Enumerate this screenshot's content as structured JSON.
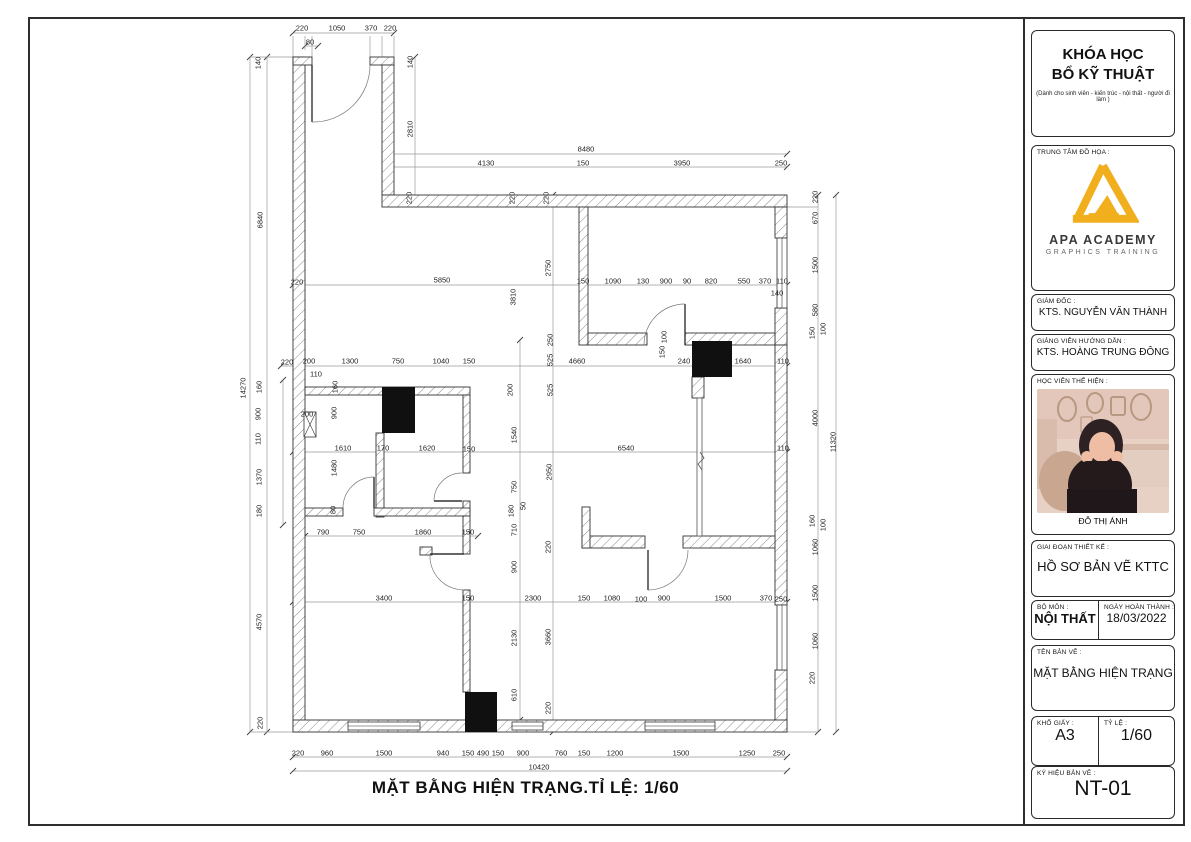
{
  "page": {
    "caption": "MẶT BẰNG HIỆN TRẠNG.TỈ LỆ: 1/60"
  },
  "title_block": {
    "course_title_line1": "KHÓA HỌC",
    "course_title_line2": "BỔ KỸ THUẬT",
    "course_subtitle": "(Dành cho sinh viên - kiến trúc - nội thất - người đi làm )",
    "center_label": "TRUNG TÂM ĐỒ HỌA :",
    "logo_name": "APA ACADEMY",
    "logo_tagline": "GRAPHICS TRAINING",
    "accent_color": "#F1AE1D",
    "director_label": "GIÁM ĐỐC :",
    "director_name": "KTS. NGUYỄN VĂN THÀNH",
    "lecturer_label": "GIẢNG VIÊN HƯỚNG DẪN :",
    "lecturer_name": "KTS. HOÀNG TRUNG ĐÔNG",
    "student_label": "HỌC VIÊN THỂ HIỆN :",
    "student_name": "ĐỖ THỊ ÁNH",
    "phase_label": "GIAI ĐOẠN THIẾT KẾ :",
    "phase_value": "HỒ SƠ BẢN VẼ KTTC",
    "subject_label": "BỘ MÔN :",
    "subject_value": "NỘI THẤT",
    "date_label": "NGÀY HOÀN THÀNH :",
    "date_value": "18/03/2022",
    "drawing_name_label": "TÊN BẢN VẼ :",
    "drawing_name_value": "MẶT BẰNG HIỆN TRẠNG",
    "paper_label": "KHỔ GIẤY :",
    "paper_value": "A3",
    "scale_label": "TỶ LỆ :",
    "scale_value": "1/60",
    "code_label": "KÝ HIỆU BẢN VẼ :",
    "code_value": "NT-01"
  },
  "plan": {
    "line_color": "#333333",
    "dim_color": "#555555",
    "walls": [
      [
        293,
        57,
        12,
        675
      ],
      [
        293,
        57,
        19,
        8
      ],
      [
        370,
        57,
        24,
        8
      ],
      [
        382,
        65,
        12,
        130
      ],
      [
        382,
        195,
        405,
        12
      ],
      [
        775,
        207,
        12,
        31
      ],
      [
        775,
        308,
        12,
        37
      ],
      [
        775,
        345,
        12,
        260
      ],
      [
        775,
        670,
        12,
        62
      ],
      [
        293,
        720,
        494,
        12
      ],
      [
        579,
        207,
        9,
        138
      ],
      [
        588,
        333,
        59,
        12
      ],
      [
        685,
        333,
        90,
        12
      ],
      [
        305,
        387,
        165,
        8
      ],
      [
        376,
        433,
        8,
        84
      ],
      [
        463,
        395,
        7,
        78
      ],
      [
        463,
        501,
        7,
        15
      ],
      [
        305,
        508,
        38,
        8
      ],
      [
        374,
        508,
        96,
        8
      ],
      [
        463,
        516,
        7,
        38
      ],
      [
        463,
        590,
        7,
        102
      ],
      [
        692,
        377,
        12,
        21
      ],
      [
        582,
        536,
        63,
        12
      ],
      [
        683,
        536,
        92,
        12
      ],
      [
        582,
        507,
        8,
        41
      ],
      [
        420,
        547,
        12,
        8
      ]
    ],
    "shafts": [
      [
        692,
        341,
        40,
        36
      ],
      [
        382,
        387,
        33,
        46
      ],
      [
        465,
        692,
        32,
        40
      ]
    ],
    "windows": [
      {
        "r": [
          777,
          238,
          10,
          70
        ],
        "o": "v"
      },
      {
        "r": [
          777,
          605,
          10,
          65
        ],
        "o": "v"
      },
      {
        "r": [
          348,
          722,
          72,
          8
        ],
        "o": "h"
      },
      {
        "r": [
          512,
          722,
          31,
          8
        ],
        "o": "h"
      },
      {
        "r": [
          645,
          722,
          70,
          8
        ],
        "o": "h"
      }
    ],
    "duct": [
      304,
      412,
      12,
      25
    ],
    "partition": {
      "r": [
        697,
        398,
        5,
        138
      ],
      "break": [
        700,
        452,
        704,
        458,
        698,
        464,
        702,
        470
      ]
    },
    "doors": [
      {
        "h": [
          312,
          65
        ],
        "l": [
          312,
          122
        ],
        "a": [
          370,
          65
        ],
        "s": 0
      },
      {
        "h": [
          685,
          345
        ],
        "l": [
          685,
          304
        ],
        "a": [
          644,
          345
        ],
        "s": 0
      },
      {
        "h": [
          374,
          508
        ],
        "l": [
          374,
          477
        ],
        "a": [
          343,
          508
        ],
        "s": 0
      },
      {
        "h": [
          462,
          501
        ],
        "l": [
          434,
          501
        ],
        "a": [
          462,
          473
        ],
        "s": 1
      },
      {
        "h": [
          648,
          550
        ],
        "l": [
          648,
          590
        ],
        "a": [
          688,
          550
        ],
        "s": 0
      },
      {
        "h": [
          464,
          554
        ],
        "l": [
          430,
          554
        ],
        "a": [
          464,
          590
        ],
        "s": 0
      }
    ],
    "dim_lines": [
      [
        293,
        33,
        394,
        33,
        1
      ],
      [
        305,
        46,
        318,
        46,
        1
      ],
      [
        385,
        154,
        787,
        154,
        1
      ],
      [
        385,
        167,
        787,
        167,
        1
      ],
      [
        293,
        285,
        787,
        285,
        1
      ],
      [
        281,
        366,
        787,
        366,
        1
      ],
      [
        293,
        452,
        787,
        452,
        1
      ],
      [
        305,
        536,
        478,
        536,
        1
      ],
      [
        293,
        602,
        787,
        602,
        1
      ],
      [
        293,
        757,
        787,
        757,
        1
      ],
      [
        293,
        771,
        787,
        771,
        1
      ],
      [
        250,
        57,
        250,
        732,
        1
      ],
      [
        267,
        57,
        267,
        732,
        1
      ],
      [
        283,
        380,
        283,
        525,
        1
      ],
      [
        415,
        57,
        415,
        200,
        1
      ],
      [
        553,
        195,
        553,
        732,
        1
      ],
      [
        520,
        340,
        520,
        720,
        1
      ],
      [
        818,
        195,
        818,
        732,
        1
      ],
      [
        836,
        195,
        836,
        732,
        1
      ],
      [
        293,
        36,
        293,
        57,
        0
      ],
      [
        305,
        36,
        305,
        50,
        0
      ],
      [
        312,
        36,
        312,
        57,
        0
      ],
      [
        370,
        36,
        370,
        57,
        0
      ],
      [
        382,
        36,
        382,
        57,
        0
      ],
      [
        394,
        36,
        394,
        57,
        0
      ],
      [
        250,
        57,
        293,
        57,
        0
      ],
      [
        250,
        732,
        293,
        732,
        0
      ],
      [
        818,
        207,
        787,
        207,
        0
      ],
      [
        818,
        732,
        787,
        732,
        0
      ]
    ],
    "dim_labels": [
      [
        302,
        28,
        "220",
        0
      ],
      [
        337,
        28,
        "1050",
        0
      ],
      [
        371,
        28,
        "370",
        0
      ],
      [
        390,
        28,
        "220",
        0
      ],
      [
        310,
        42,
        "80",
        0
      ],
      [
        258,
        63,
        "140",
        1
      ],
      [
        410,
        62,
        "140",
        1
      ],
      [
        410,
        129,
        "2810",
        1
      ],
      [
        586,
        149,
        "8480",
        0
      ],
      [
        486,
        163,
        "4130",
        0
      ],
      [
        583,
        163,
        "150",
        0
      ],
      [
        682,
        163,
        "3950",
        0
      ],
      [
        781,
        163,
        "250",
        0
      ],
      [
        409,
        198,
        "220",
        1
      ],
      [
        512,
        198,
        "220",
        1
      ],
      [
        546,
        198,
        "220",
        1
      ],
      [
        815,
        197,
        "220",
        1
      ],
      [
        815,
        218,
        "670",
        1
      ],
      [
        815,
        265,
        "1500",
        1
      ],
      [
        815,
        310,
        "580",
        1
      ],
      [
        812,
        333,
        "150",
        1
      ],
      [
        823,
        329,
        "100",
        1
      ],
      [
        815,
        418,
        "4000",
        1
      ],
      [
        833,
        442,
        "11320",
        1
      ],
      [
        812,
        521,
        "160",
        1
      ],
      [
        823,
        525,
        "100",
        1
      ],
      [
        815,
        547,
        "1060",
        1
      ],
      [
        815,
        593,
        "1500",
        1
      ],
      [
        815,
        641,
        "1060",
        1
      ],
      [
        812,
        678,
        "220",
        1
      ],
      [
        442,
        280,
        "5850",
        0
      ],
      [
        583,
        281,
        "150",
        0
      ],
      [
        613,
        281,
        "1090",
        0
      ],
      [
        643,
        281,
        "130",
        0
      ],
      [
        666,
        281,
        "900",
        0
      ],
      [
        687,
        281,
        "90",
        0
      ],
      [
        711,
        281,
        "820",
        0
      ],
      [
        744,
        281,
        "550",
        0
      ],
      [
        765,
        281,
        "370",
        0
      ],
      [
        782,
        281,
        "110",
        0
      ],
      [
        777,
        293,
        "140",
        0
      ],
      [
        548,
        268,
        "2750",
        1
      ],
      [
        513,
        297,
        "3810",
        1
      ],
      [
        297,
        282,
        "220",
        0
      ],
      [
        287,
        362,
        "220",
        0
      ],
      [
        309,
        361,
        "200",
        0
      ],
      [
        350,
        361,
        "1300",
        0
      ],
      [
        398,
        361,
        "750",
        0
      ],
      [
        441,
        361,
        "1040",
        0
      ],
      [
        469,
        361,
        "150",
        0
      ],
      [
        316,
        374,
        "110",
        0
      ],
      [
        577,
        361,
        "4660",
        0
      ],
      [
        684,
        361,
        "240",
        0
      ],
      [
        743,
        361,
        "1640",
        0
      ],
      [
        783,
        361,
        "110",
        0
      ],
      [
        664,
        337,
        "100",
        1
      ],
      [
        662,
        352,
        "150",
        1
      ],
      [
        550,
        340,
        "250",
        1
      ],
      [
        550,
        360,
        "525",
        1
      ],
      [
        550,
        390,
        "525",
        1
      ],
      [
        549,
        472,
        "2950",
        1
      ],
      [
        548,
        547,
        "220",
        1
      ],
      [
        548,
        637,
        "3660",
        1
      ],
      [
        548,
        708,
        "220",
        1
      ],
      [
        510,
        390,
        "200",
        1
      ],
      [
        514,
        435,
        "1540",
        1
      ],
      [
        514,
        487,
        "750",
        1
      ],
      [
        523,
        506,
        "50",
        1
      ],
      [
        511,
        511,
        "180",
        1
      ],
      [
        514,
        530,
        "710",
        1
      ],
      [
        514,
        567,
        "900",
        1
      ],
      [
        514,
        638,
        "2130",
        1
      ],
      [
        514,
        695,
        "610",
        1
      ],
      [
        243,
        388,
        "14270",
        1
      ],
      [
        260,
        220,
        "6840",
        1
      ],
      [
        259,
        387,
        "160",
        1
      ],
      [
        258,
        414,
        "900",
        1
      ],
      [
        258,
        439,
        "110",
        1
      ],
      [
        259,
        477,
        "1370",
        1
      ],
      [
        259,
        511,
        "180",
        1
      ],
      [
        259,
        622,
        "4570",
        1
      ],
      [
        260,
        723,
        "220",
        1
      ],
      [
        307,
        414,
        "200",
        0
      ],
      [
        334,
        413,
        "900",
        1
      ],
      [
        334,
        468,
        "1480",
        1
      ],
      [
        335,
        387,
        "160",
        1
      ],
      [
        333,
        510,
        "80",
        1
      ],
      [
        343,
        448,
        "1610",
        0
      ],
      [
        383,
        448,
        "170",
        0
      ],
      [
        427,
        448,
        "1620",
        0
      ],
      [
        469,
        449,
        "150",
        0
      ],
      [
        626,
        448,
        "6540",
        0
      ],
      [
        783,
        448,
        "110",
        0
      ],
      [
        323,
        532,
        "790",
        0
      ],
      [
        359,
        532,
        "750",
        0
      ],
      [
        423,
        532,
        "1860",
        0
      ],
      [
        468,
        532,
        "150",
        0
      ],
      [
        384,
        598,
        "3400",
        0
      ],
      [
        468,
        598,
        "150",
        0
      ],
      [
        533,
        598,
        "2300",
        0
      ],
      [
        584,
        598,
        "150",
        0
      ],
      [
        612,
        598,
        "1080",
        0
      ],
      [
        641,
        599,
        "100",
        0
      ],
      [
        664,
        598,
        "900",
        0
      ],
      [
        723,
        598,
        "1500",
        0
      ],
      [
        766,
        598,
        "370",
        0
      ],
      [
        781,
        599,
        "250",
        0
      ],
      [
        298,
        753,
        "220",
        0
      ],
      [
        327,
        753,
        "960",
        0
      ],
      [
        384,
        753,
        "1500",
        0
      ],
      [
        443,
        753,
        "940",
        0
      ],
      [
        468,
        753,
        "150",
        0
      ],
      [
        483,
        753,
        "490",
        0
      ],
      [
        498,
        753,
        "150",
        0
      ],
      [
        523,
        753,
        "900",
        0
      ],
      [
        561,
        753,
        "760",
        0
      ],
      [
        584,
        753,
        "150",
        0
      ],
      [
        615,
        753,
        "1200",
        0
      ],
      [
        681,
        753,
        "1500",
        0
      ],
      [
        747,
        753,
        "1250",
        0
      ],
      [
        779,
        753,
        "250",
        0
      ],
      [
        539,
        767,
        "10420",
        0
      ]
    ]
  }
}
